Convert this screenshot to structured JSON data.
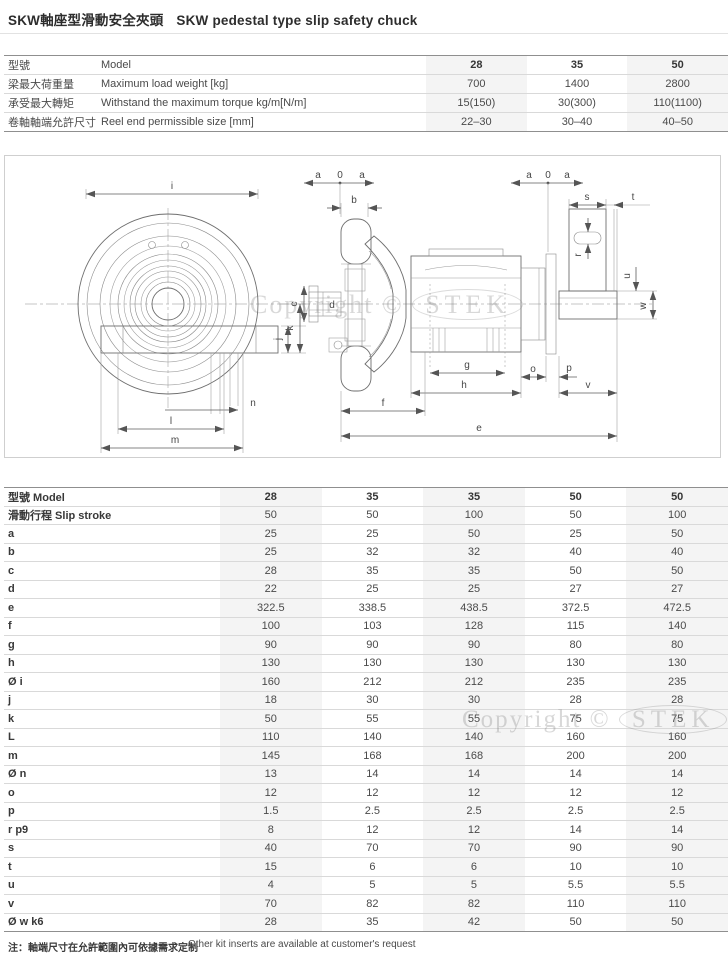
{
  "title": {
    "cn": "SKW軸座型滑動安全夾頭",
    "en": "SKW pedestal type slip safety chuck"
  },
  "watermark": {
    "prefix": "Copyright ©",
    "brand": "STEK"
  },
  "spec_table": {
    "rows": [
      {
        "cn": "型號",
        "en": "Model",
        "values": [
          "28",
          "35",
          "50"
        ],
        "header": true
      },
      {
        "cn": "梁最大荷重量",
        "en": "Maximum load weight [kg]",
        "values": [
          "700",
          "1400",
          "2800"
        ]
      },
      {
        "cn": "承受最大轉矩",
        "en": "Withstand the maximum torque kg/m[N/m]",
        "values": [
          "15(150)",
          "30(300)",
          "110(1100)"
        ]
      },
      {
        "cn": "卷軸軸端允許尺寸",
        "en": "Reel end permissible size [mm]",
        "values": [
          "22–30",
          "30–40",
          "40–50"
        ]
      }
    ]
  },
  "dim_table": {
    "header_label": "型號  Model",
    "header_values": [
      "28",
      "35",
      "35",
      "50",
      "50"
    ],
    "rows": [
      {
        "label": "滑動行程  Slip stroke",
        "values": [
          "50",
          "50",
          "100",
          "50",
          "100"
        ]
      },
      {
        "label": "a",
        "values": [
          "25",
          "25",
          "50",
          "25",
          "50"
        ]
      },
      {
        "label": "b",
        "values": [
          "25",
          "32",
          "32",
          "40",
          "40"
        ]
      },
      {
        "label": "c",
        "values": [
          "28",
          "35",
          "35",
          "50",
          "50"
        ]
      },
      {
        "label": "d",
        "values": [
          "22",
          "25",
          "25",
          "27",
          "27"
        ]
      },
      {
        "label": "e",
        "values": [
          "322.5",
          "338.5",
          "438.5",
          "372.5",
          "472.5"
        ]
      },
      {
        "label": "f",
        "values": [
          "100",
          "103",
          "128",
          "115",
          "140"
        ]
      },
      {
        "label": "g",
        "values": [
          "90",
          "90",
          "90",
          "80",
          "80"
        ]
      },
      {
        "label": "h",
        "values": [
          "130",
          "130",
          "130",
          "130",
          "130"
        ]
      },
      {
        "label": "Ø i",
        "values": [
          "160",
          "212",
          "212",
          "235",
          "235"
        ]
      },
      {
        "label": "j",
        "values": [
          "18",
          "30",
          "30",
          "28",
          "28"
        ]
      },
      {
        "label": "k",
        "values": [
          "50",
          "55",
          "55",
          "75",
          "75"
        ]
      },
      {
        "label": "L",
        "values": [
          "110",
          "140",
          "140",
          "160",
          "160"
        ]
      },
      {
        "label": "m",
        "values": [
          "145",
          "168",
          "168",
          "200",
          "200"
        ]
      },
      {
        "label": "Ø n",
        "values": [
          "13",
          "14",
          "14",
          "14",
          "14"
        ]
      },
      {
        "label": "o",
        "values": [
          "12",
          "12",
          "12",
          "12",
          "12"
        ]
      },
      {
        "label": "p",
        "values": [
          "1.5",
          "2.5",
          "2.5",
          "2.5",
          "2.5"
        ]
      },
      {
        "label": "r p9",
        "values": [
          "8",
          "12",
          "12",
          "14",
          "14"
        ]
      },
      {
        "label": "s",
        "values": [
          "40",
          "70",
          "70",
          "90",
          "90"
        ]
      },
      {
        "label": "t",
        "values": [
          "15",
          "6",
          "6",
          "10",
          "10"
        ]
      },
      {
        "label": "u",
        "values": [
          "4",
          "5",
          "5",
          "5.5",
          "5.5"
        ]
      },
      {
        "label": "v",
        "values": [
          "70",
          "82",
          "82",
          "110",
          "110"
        ]
      },
      {
        "label": "Ø w k6",
        "values": [
          "28",
          "35",
          "42",
          "50",
          "50"
        ]
      }
    ]
  },
  "diagram": {
    "labels": {
      "i": "i",
      "j": "j",
      "k": "k",
      "l": "l",
      "m": "m",
      "n": "n",
      "a": "a",
      "zero": "0",
      "b": "b",
      "c": "c",
      "d": "d",
      "e": "e",
      "f": "f",
      "g": "g",
      "h": "h",
      "o": "o",
      "p": "p",
      "r": "r",
      "s": "s",
      "t": "t",
      "u": "u",
      "v": "v",
      "w": "w"
    }
  },
  "footnote": {
    "cn": "注：軸端尺寸在允許範圍內可依據需求定制",
    "en": "Other kit inserts are available at customer's request"
  }
}
